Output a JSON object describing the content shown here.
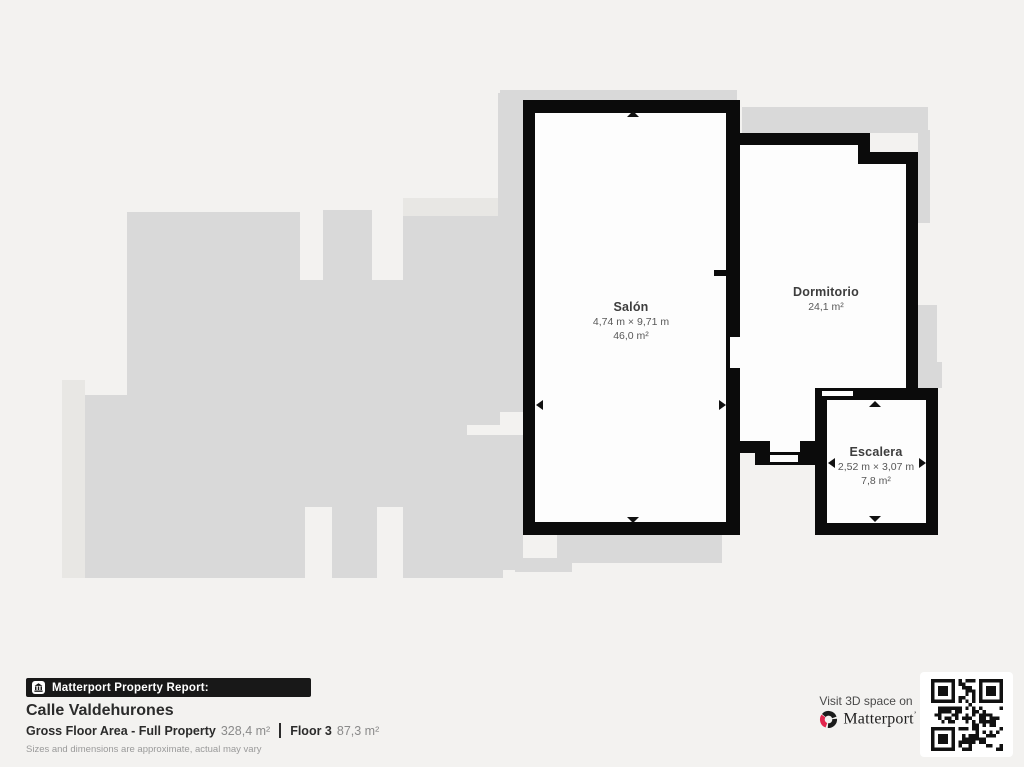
{
  "plan": {
    "floor_label_internal": "Floor 3",
    "rooms": [
      {
        "name": "Salón",
        "dimensions": "4,74 m × 9,71 m",
        "area": "46,0 m²"
      },
      {
        "name": "Dormitorio",
        "dimensions": "",
        "area": "24,1 m²"
      },
      {
        "name": "Escalera",
        "dimensions": "2,52 m × 3,07 m",
        "area": "7,8 m²"
      }
    ]
  },
  "footer": {
    "report_bar": "Matterport Property Report:",
    "address": "Calle Valdehurones",
    "gross_label": "Gross Floor Area - Full Property",
    "gross_value": "328,4 m²",
    "floor_label": "Floor 3",
    "floor_value": "87,3 m²",
    "disclaimer": "Sizes and dimensions are approximate, actual may vary"
  },
  "cta": {
    "visit_text": "Visit 3D space on",
    "brand": "Matterport",
    "icons": [
      "matterport-logo-icon",
      "qr-code",
      "building-icon"
    ]
  },
  "colors": {
    "background": "#f3f2f0",
    "silhouette": "#d9d9d9",
    "wall": "#0b0b0b",
    "room_fill": "#fdfdfd",
    "brand_red": "#e2264d",
    "text_dark": "#2b2b2b",
    "text_gray": "#8a8a8a"
  }
}
